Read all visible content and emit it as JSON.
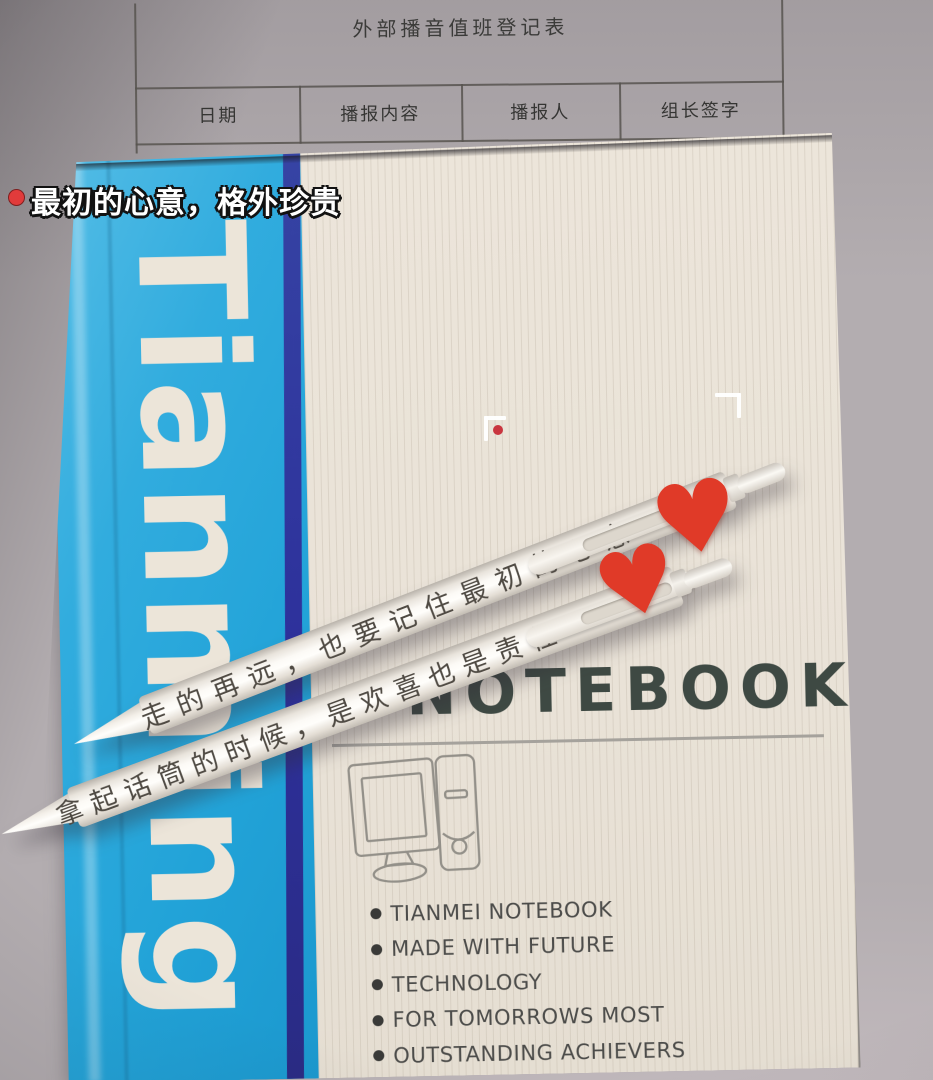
{
  "form": {
    "title": "外部播音值班登记表",
    "columns": [
      "日期",
      "播报内容",
      "播报人",
      "组长签字"
    ]
  },
  "caption": {
    "text": "最初的心意，格外珍贵",
    "bullet_color": "#e13b3b"
  },
  "notebook": {
    "spine_text": "Tianming",
    "cover_title": "NOTEBOOK",
    "features": [
      "TIANMEI NOTEBOOK",
      "MADE WITH FUTURE",
      "TECHNOLOGY",
      "FOR TOMORROWS MOST",
      "OUTSTANDING ACHIEVERS"
    ],
    "spine_color": "#2aa7da",
    "stripe_color": "#2f339b",
    "cover_color": "#e9e2d7"
  },
  "pens": {
    "pen_top_text": "走的再远，也要记住最初的心意",
    "pen_bottom_text": "拿起话筒的时候，是欢喜也是责任",
    "heart_icon": "♥",
    "heart_color": "#e03a28"
  }
}
